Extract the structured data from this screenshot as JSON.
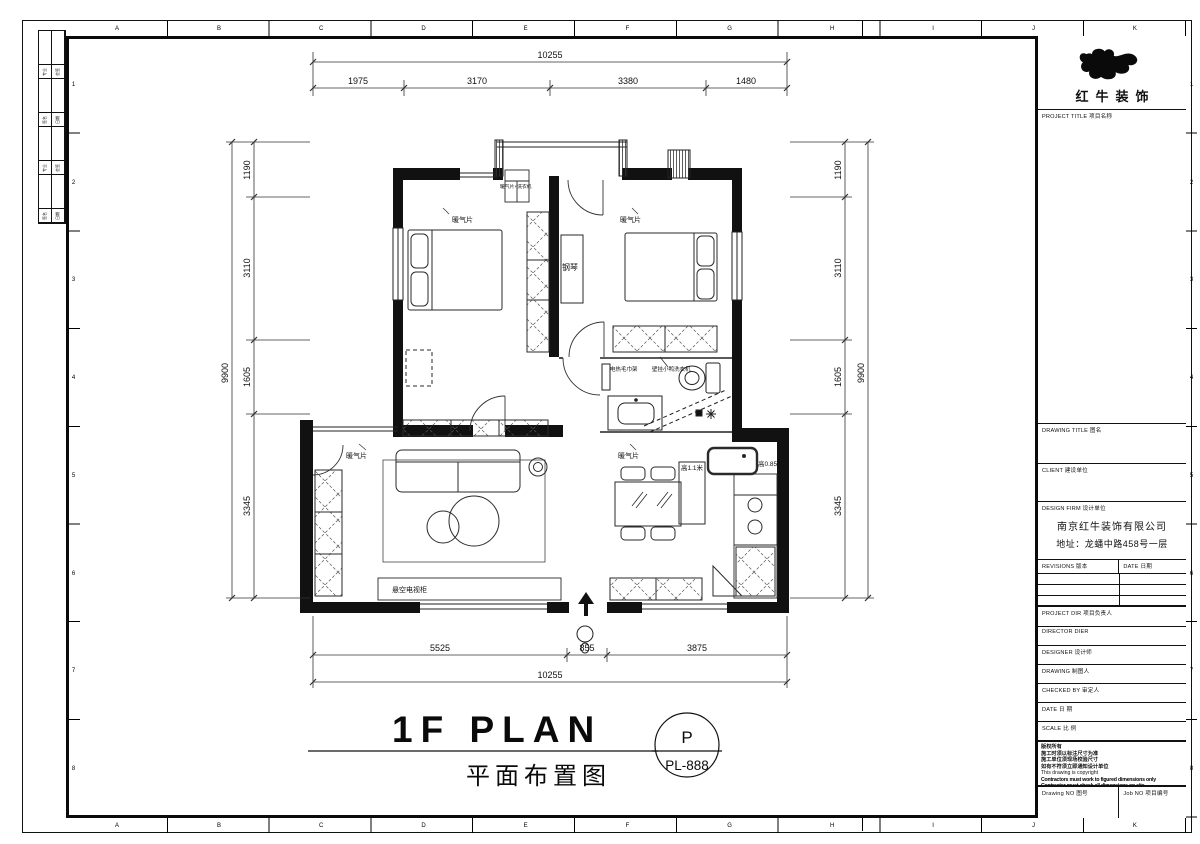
{
  "sheet": {
    "ruler_letters": [
      "A",
      "B",
      "C",
      "D",
      "E",
      "F",
      "G",
      "H",
      "I",
      "J",
      "K"
    ],
    "ruler_numbers": [
      "1",
      "2",
      "3",
      "4",
      "5",
      "6",
      "7",
      "8"
    ],
    "sign_rows": [
      [
        "专业",
        "会签"
      ],
      [
        "签名",
        "日期"
      ],
      [
        "专业",
        "会签"
      ],
      [
        "签名",
        "日期"
      ]
    ]
  },
  "title_block": {
    "brand": "红牛装饰",
    "project_title": "PROJECT TITLE  项目名称",
    "drawing_title": "DRAWING TITLE  图名",
    "client": "CLIENT  建设单位",
    "design_firm_label": "DESIGN FIRM  设计单位",
    "design_firm_name": "南京红牛装饰有限公司",
    "design_firm_addr": "地址：龙蟠中路458号一层",
    "revisions": "REVISIONS  版本",
    "rev_date": "DATE  日期",
    "project_dir": "PROJECT DIR  项目负责人",
    "director": "DIRECTOR DIER",
    "designer": "DESIGNER   设计师",
    "drawing": "DRAWING    制图人",
    "checked_by": "CHECKED BY  审定人",
    "date": "DATE       日 期",
    "scale": "SCALE      比 例",
    "copyright_cn": [
      "版权所有",
      "施工时须以标注尺寸为准",
      "施工单位须现场校验尺寸",
      "如有不符须立即通知设计单位"
    ],
    "copyright_en": [
      "This drawing is copyright",
      "Contractors must work to figured dimensions only",
      "Contractor must check all dimensions on site",
      "Mistakes must be reported immediately to architects"
    ],
    "drawing_no": "Drawing NO  图号",
    "job_no": "Job NO  项目编号"
  },
  "plan": {
    "title_en": "1F PLAN",
    "title_cn": "平面布置图",
    "stamp_letter": "P",
    "stamp_code": "PL-888",
    "labels": {
      "radiator": "暖气片",
      "piano": "钢琴",
      "balcony_unit": "暖气片+洗衣机",
      "towel": "电热毛巾架",
      "washer": "壁挂小鸭洗衣机",
      "bar_height": "高1.1米",
      "sink_height": "高0.85米",
      "tv_cabinet": "悬空电视柜"
    }
  },
  "dims": {
    "top_overall": "10255",
    "top_seg": [
      "1975",
      "3170",
      "3380",
      "1480"
    ],
    "side_overall": "9900",
    "side_seg": [
      "1190",
      "3110",
      "1605",
      "3345"
    ],
    "bottom_seg": [
      "5525",
      "855",
      "3875"
    ],
    "bottom_overall": "10255"
  }
}
